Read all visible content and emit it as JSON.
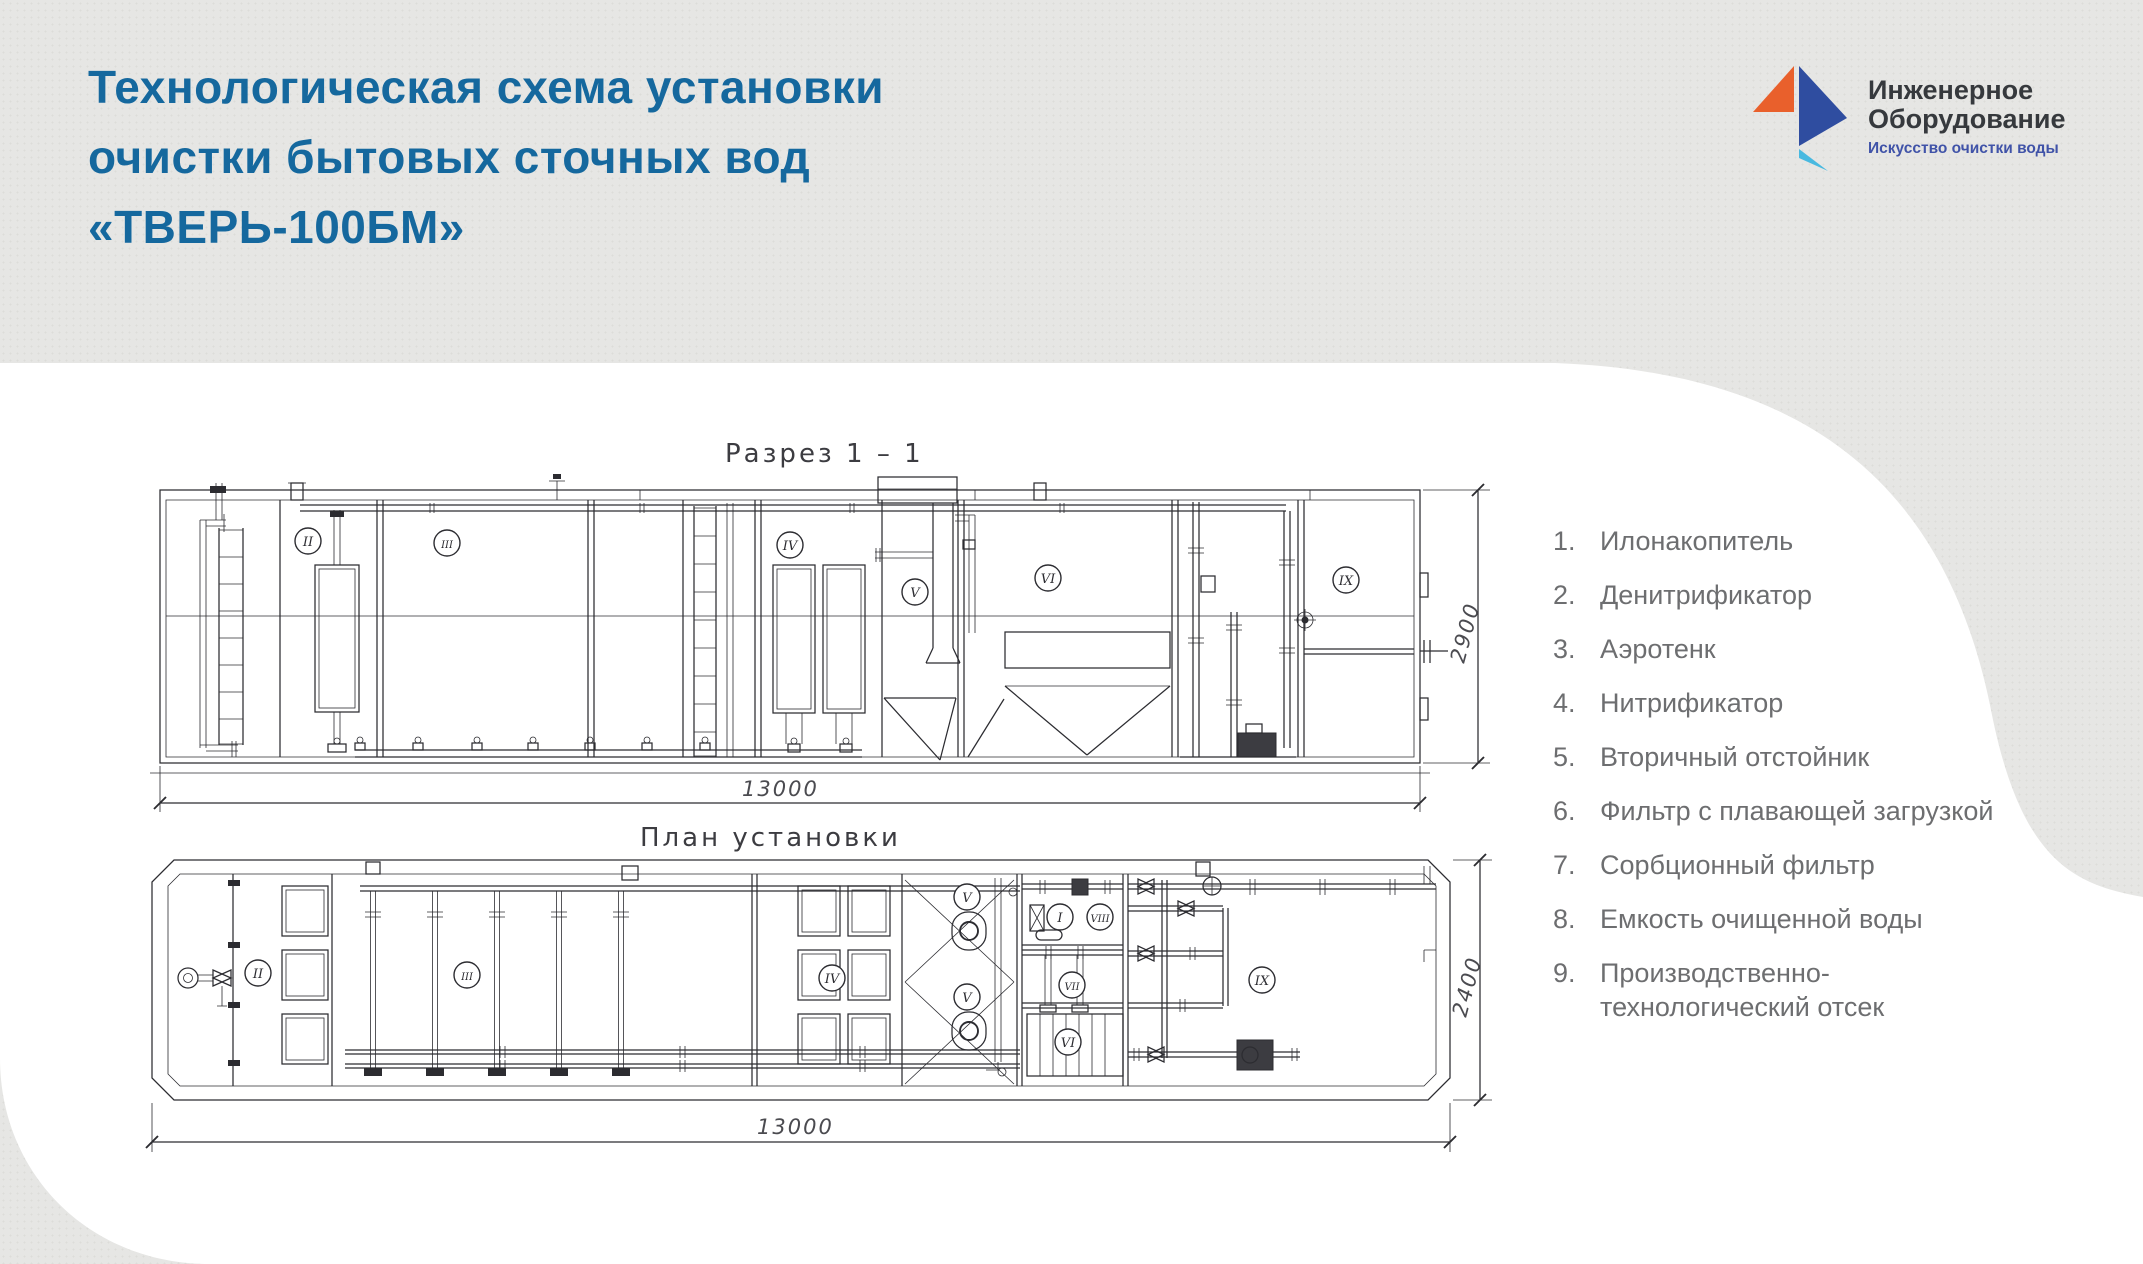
{
  "page": {
    "background": "#e6e6e4",
    "panel": "#ffffff"
  },
  "header": {
    "title_lines": [
      "Технологическая схема установки",
      "очистки бытовых сточных вод",
      "«ТВЕРЬ-100БМ»"
    ],
    "title_color": "#15689e"
  },
  "logo": {
    "name_line1": "Инженерное",
    "name_line2": "Оборудование",
    "tagline": "Искусство очистки воды",
    "orange": "#e9602c",
    "blue": "#2f4da0",
    "cyan": "#49b9e0",
    "tagline_color": "#4053a8"
  },
  "drawing": {
    "section_title": "Разрез  1 – 1",
    "plan_title": "План установки",
    "dims": {
      "section_length": "13000",
      "section_height": "2900",
      "plan_length": "13000",
      "plan_width": "2400"
    },
    "section_labels": [
      {
        "n": "II",
        "x": 308,
        "y": 541
      },
      {
        "n": "III",
        "x": 447,
        "y": 543
      },
      {
        "n": "IV",
        "x": 790,
        "y": 545
      },
      {
        "n": "V",
        "x": 915,
        "y": 592
      },
      {
        "n": "VI",
        "x": 1048,
        "y": 578
      },
      {
        "n": "IX",
        "x": 1346,
        "y": 580
      }
    ],
    "plan_labels": [
      {
        "n": "II",
        "x": 258,
        "y": 973
      },
      {
        "n": "III",
        "x": 467,
        "y": 975
      },
      {
        "n": "IV",
        "x": 832,
        "y": 978
      },
      {
        "n": "V",
        "x": 967,
        "y": 897
      },
      {
        "n": "V",
        "x": 967,
        "y": 997
      },
      {
        "n": "I",
        "x": 1060,
        "y": 917
      },
      {
        "n": "VIII",
        "x": 1100,
        "y": 917
      },
      {
        "n": "VII",
        "x": 1072,
        "y": 985
      },
      {
        "n": "VI",
        "x": 1068,
        "y": 1042
      },
      {
        "n": "IX",
        "x": 1262,
        "y": 980
      }
    ]
  },
  "legend": {
    "items": [
      {
        "num": "1.",
        "text": "Илонакопитель"
      },
      {
        "num": "2.",
        "text": "Денитрификатор"
      },
      {
        "num": "3.",
        "text": "Аэротенк"
      },
      {
        "num": "4.",
        "text": "Нитрификатор"
      },
      {
        "num": "5.",
        "text": "Вторичный отстойник"
      },
      {
        "num": "6.",
        "text": "Фильтр с плавающей загрузкой"
      },
      {
        "num": "7.",
        "text": "Сорбционный фильтр"
      },
      {
        "num": "8.",
        "text": "Емкость очищенной воды"
      },
      {
        "num": "9.",
        "text": "Производственно-технологический отсек"
      }
    ]
  }
}
